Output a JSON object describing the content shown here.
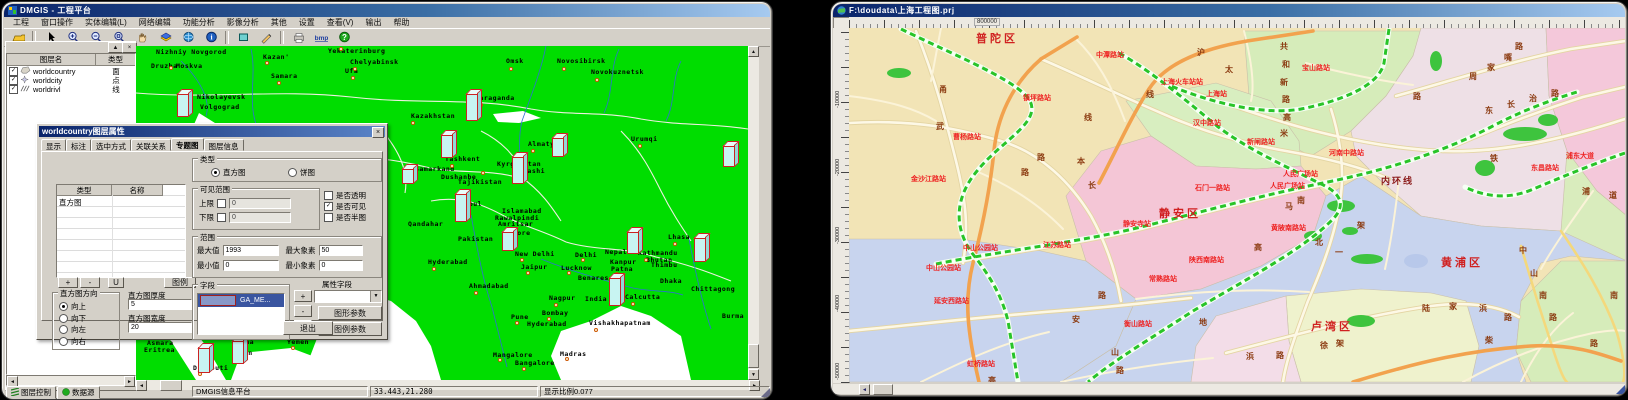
{
  "left_window": {
    "title": "DMGIS - 工程平台",
    "menus": [
      "工程",
      "窗口操作",
      "实体编辑(L)",
      "网络编辑",
      "功能分析",
      "影像分析",
      "其他",
      "设置",
      "查看(V)",
      "输出",
      "帮助"
    ],
    "toolbar_icons": [
      "open-folder",
      "select-arrow",
      "zoom-in",
      "zoom-out",
      "zoom-window",
      "pan-hand",
      "layers-flag",
      "refresh-globe",
      "info",
      "select-rect",
      "measure-pencil",
      "print",
      "export-bmp",
      "help"
    ],
    "layer_panel": {
      "headers": [
        "图层名",
        "类型"
      ],
      "min_button": "▲",
      "close_button": "×",
      "layers": [
        {
          "name": "worldcountry",
          "type": "面",
          "checked": true,
          "icon": "polygon-layer-icon"
        },
        {
          "name": "worldcity",
          "type": "点",
          "checked": true,
          "icon": "point-layer-icon"
        },
        {
          "name": "worldrivl",
          "type": "线",
          "checked": true,
          "icon": "line-layer-icon"
        }
      ],
      "tabs": [
        "图层控制",
        "数据源"
      ]
    },
    "status_bar": [
      "DMGIS信息平台",
      "33.443,21.280",
      "显示比例0.077"
    ],
    "map": {
      "cities": [
        [
          "Nizhniy Novgorod",
          155,
          50
        ],
        [
          "Druzba",
          150,
          64
        ],
        [
          "Moskva",
          175,
          64
        ],
        [
          "Kazan'",
          262,
          55
        ],
        [
          "Perm'",
          333,
          40
        ],
        [
          "Yekaterinburg",
          327,
          49
        ],
        [
          "Chelyabinsk",
          349,
          60
        ],
        [
          "Samara",
          270,
          74
        ],
        [
          "Ufa",
          344,
          69
        ],
        [
          "Nikolayevsk",
          196,
          95
        ],
        [
          "Volgograd",
          199,
          105
        ],
        [
          "Russia",
          619,
          33
        ],
        [
          "Omsk",
          505,
          59
        ],
        [
          "Novosibirsk",
          556,
          59
        ],
        [
          "Novokuznetsk",
          590,
          70
        ],
        [
          "Karaganda",
          474,
          96
        ],
        [
          "Kazakhstan",
          410,
          114
        ],
        [
          "Almaty",
          527,
          142
        ],
        [
          "Urumqi",
          630,
          137
        ],
        [
          "Tashkent",
          444,
          157
        ],
        [
          "Samarkand",
          414,
          167
        ],
        [
          "Kyrgyzstan",
          496,
          162
        ],
        [
          "Kashi",
          522,
          169
        ],
        [
          "Dushanbe",
          440,
          175
        ],
        [
          "Tajikistan",
          457,
          180
        ],
        [
          "Kabul",
          459,
          202
        ],
        [
          "Islamabad",
          501,
          209
        ],
        [
          "Rawalpindi",
          494,
          216
        ],
        [
          "Amritsar",
          497,
          222
        ],
        [
          "Lahore",
          503,
          231
        ],
        [
          "Qandahar",
          407,
          222
        ],
        [
          "Pakistan",
          457,
          237
        ],
        [
          "New Delhi",
          514,
          252
        ],
        [
          "Delhi",
          574,
          253
        ],
        [
          "Jaipur",
          520,
          265
        ],
        [
          "Lucknow",
          560,
          266
        ],
        [
          "Kanpur",
          609,
          260
        ],
        [
          "Patna",
          610,
          267
        ],
        [
          "Nepal",
          604,
          250
        ],
        [
          "Kathmandu",
          637,
          251
        ],
        [
          "Bhutan",
          645,
          258
        ],
        [
          "Thimbu",
          650,
          263
        ],
        [
          "Lhasa",
          667,
          235
        ],
        [
          "Hyderabad",
          427,
          260
        ],
        [
          "Ahmadabad",
          468,
          284
        ],
        [
          "Nagpur",
          548,
          296
        ],
        [
          "India",
          584,
          297
        ],
        [
          "Calcutta",
          624,
          295
        ],
        [
          "Benares",
          577,
          276
        ],
        [
          "Dhaka",
          659,
          279
        ],
        [
          "Chittagong",
          690,
          287
        ],
        [
          "Bombay",
          541,
          311
        ],
        [
          "Pune",
          510,
          315
        ],
        [
          "Hyderabad",
          526,
          322
        ],
        [
          "Vishakhapatnam",
          588,
          321
        ],
        [
          "Burma",
          721,
          314
        ],
        [
          "Mangalore",
          492,
          353
        ],
        [
          "Madras",
          559,
          352
        ],
        [
          "Bangalore",
          514,
          361
        ],
        [
          "Asmara",
          146,
          341
        ],
        [
          "Eritrea",
          143,
          348
        ],
        [
          "Sanaa",
          231,
          340
        ],
        [
          "Aden",
          234,
          351
        ],
        [
          "Yemen",
          286,
          340
        ],
        [
          "Djibouti",
          192,
          366
        ]
      ],
      "dots": [
        [
          168,
          65
        ],
        [
          264,
          60
        ],
        [
          338,
          46
        ],
        [
          352,
          66
        ],
        [
          276,
          80
        ],
        [
          350,
          75
        ],
        [
          508,
          66
        ],
        [
          561,
          66
        ],
        [
          594,
          77
        ],
        [
          478,
          102
        ],
        [
          530,
          148
        ],
        [
          637,
          143
        ],
        [
          449,
          163
        ],
        [
          463,
          209
        ],
        [
          504,
          237
        ],
        [
          519,
          257
        ],
        [
          580,
          257
        ],
        [
          525,
          270
        ],
        [
          566,
          270
        ],
        [
          614,
          271
        ],
        [
          643,
          257
        ],
        [
          672,
          241
        ],
        [
          431,
          266
        ],
        [
          473,
          290
        ],
        [
          553,
          302
        ],
        [
          630,
          301
        ],
        [
          546,
          316
        ],
        [
          514,
          320
        ],
        [
          593,
          327
        ],
        [
          497,
          357
        ],
        [
          564,
          356
        ],
        [
          521,
          366
        ],
        [
          237,
          355
        ],
        [
          290,
          345
        ],
        [
          197,
          371
        ],
        [
          410,
          120
        ],
        [
          480,
          170
        ]
      ],
      "bars": [
        [
          176,
          92,
          24
        ],
        [
          197,
          346,
          26
        ],
        [
          231,
          339,
          24
        ],
        [
          465,
          92,
          28
        ],
        [
          440,
          133,
          24
        ],
        [
          551,
          136,
          20
        ],
        [
          646,
          31,
          13
        ],
        [
          401,
          167,
          16
        ],
        [
          511,
          155,
          28
        ],
        [
          454,
          192,
          29
        ],
        [
          501,
          230,
          20
        ],
        [
          626,
          230,
          23
        ],
        [
          693,
          236,
          25
        ],
        [
          608,
          276,
          29
        ],
        [
          722,
          144,
          22
        ]
      ]
    }
  },
  "dialog": {
    "title": "worldcountry图层属性",
    "close_glyph": "×",
    "tabs": [
      "显示",
      "标注",
      "选中方式",
      "关联关系",
      "专题图",
      "图层信息"
    ],
    "active_tab_index": 4,
    "table": {
      "headers": [
        "类型",
        "名称"
      ],
      "rows": [
        [
          "直方图",
          ""
        ]
      ]
    },
    "list_buttons": [
      "+",
      "-",
      "U"
    ],
    "legend_button": "图例",
    "type_group": {
      "label": "类型",
      "option1": "直方图",
      "option2": "饼图",
      "selected": "直方图"
    },
    "visible_range": {
      "label": "可见范围",
      "upper_label": "上限",
      "upper_value": "0",
      "lower_label": "下限",
      "lower_value": "0"
    },
    "checks": [
      {
        "label": "是否透明",
        "checked": false
      },
      {
        "label": "是否可见",
        "checked": true
      },
      {
        "label": "是否半图",
        "checked": false
      }
    ],
    "range_group": {
      "label": "范围",
      "max_label": "最大值",
      "max_value": "1993",
      "maxpx_label": "最大象素",
      "maxpx_value": "50",
      "min_label": "最小值",
      "min_value": "0",
      "minpx_label": "最小象素",
      "minpx_value": "0"
    },
    "direction_group": {
      "label": "直方图方向",
      "options": [
        "向上",
        "向下",
        "向左",
        "向右"
      ],
      "selected_index": 0
    },
    "thickness_label": "直方图厚度",
    "thickness_value": "5",
    "width_label": "直方图宽度",
    "width_value": "20",
    "field_group": {
      "label": "字段",
      "selected_item": "GA_ME..."
    },
    "field_buttons": [
      "+",
      "-",
      "U"
    ],
    "attr_field_label": "属性字段",
    "graphic_param_button": "图形参数",
    "legend_param_button": "图例参数",
    "exit_button": "退出"
  },
  "right_window": {
    "title": "F:\\doudata\\上海工程图.prj",
    "ruler": {
      "top_label": "800000",
      "left_labels": [
        [
          "-10000",
          60
        ],
        [
          "-20000",
          128
        ],
        [
          "-30000",
          196
        ],
        [
          "-40000",
          264
        ],
        [
          "-50000",
          332
        ]
      ]
    },
    "map": {
      "districts": [
        [
          "普陀区",
          975,
          29
        ],
        [
          "静安区",
          1158,
          204
        ],
        [
          "黄浦区",
          1440,
          253
        ],
        [
          "卢湾区",
          1310,
          317
        ]
      ],
      "ring_road_label": [
        "内环线",
        1380,
        173
      ],
      "stations": [
        [
          "中潭路站",
          1095,
          49
        ],
        [
          "上海火车站站",
          1160,
          76
        ],
        [
          "上海站",
          1205,
          88
        ],
        [
          "镇坪路站",
          1022,
          92
        ],
        [
          "曹杨路站",
          952,
          131
        ],
        [
          "金沙江路站",
          910,
          173
        ],
        [
          "汉中路站",
          1192,
          117
        ],
        [
          "新闸路站",
          1246,
          136
        ],
        [
          "石门一路站",
          1194,
          182
        ],
        [
          "静安寺站",
          1122,
          218
        ],
        [
          "中山公园站",
          962,
          242
        ],
        [
          "中山公园站",
          925,
          262
        ],
        [
          "江苏路站",
          1042,
          239
        ],
        [
          "陕西南路站",
          1188,
          254
        ],
        [
          "人民广场站",
          1282,
          168
        ],
        [
          "人民广场站",
          1269,
          180
        ],
        [
          "河南中路站",
          1328,
          147
        ],
        [
          "黄陂南路站",
          1270,
          222
        ],
        [
          "宝山路站",
          1301,
          62
        ],
        [
          "东昌路站",
          1530,
          162
        ],
        [
          "常熟路站",
          1148,
          273
        ],
        [
          "衡山路站",
          1123,
          318
        ],
        [
          "延安西路站",
          933,
          295
        ],
        [
          "虹桥路站",
          966,
          358
        ],
        [
          "浦东大道",
          1565,
          150
        ]
      ],
      "road_chars": [
        [
          "沪",
          1196,
          46
        ],
        [
          "太",
          1224,
          63
        ],
        [
          "甬",
          938,
          83
        ],
        [
          "武",
          935,
          120
        ],
        [
          "共",
          1279,
          40
        ],
        [
          "和",
          1281,
          58
        ],
        [
          "新",
          1279,
          76
        ],
        [
          "路",
          1281,
          93
        ],
        [
          "高",
          1282,
          111
        ],
        [
          "米",
          1279,
          127
        ],
        [
          "周",
          1468,
          70
        ],
        [
          "家",
          1486,
          61
        ],
        [
          "嘴",
          1503,
          51
        ],
        [
          "路",
          1514,
          40
        ],
        [
          "路",
          1412,
          90
        ],
        [
          "东",
          1484,
          104
        ],
        [
          "长",
          1506,
          98
        ],
        [
          "治",
          1528,
          92
        ],
        [
          "路",
          1550,
          87
        ],
        [
          "路",
          1036,
          151
        ],
        [
          "路",
          1020,
          166
        ],
        [
          "本",
          1076,
          155
        ],
        [
          "长",
          1087,
          179
        ],
        [
          "线",
          1083,
          111
        ],
        [
          "线",
          1145,
          88
        ],
        [
          "安",
          1071,
          313
        ],
        [
          "路",
          1097,
          289
        ],
        [
          "山",
          1110,
          346
        ],
        [
          "路",
          1115,
          364
        ],
        [
          "高",
          987,
          374
        ],
        [
          "地",
          1198,
          316
        ],
        [
          "徐",
          1319,
          339
        ],
        [
          "架",
          1335,
          337
        ],
        [
          "浜",
          1245,
          350
        ],
        [
          "路",
          1275,
          349
        ],
        [
          "陆",
          1421,
          302
        ],
        [
          "家",
          1448,
          300
        ],
        [
          "浜",
          1478,
          302
        ],
        [
          "路",
          1503,
          311
        ],
        [
          "柴",
          1484,
          334
        ],
        [
          "南",
          1538,
          289
        ],
        [
          "南",
          1609,
          289
        ],
        [
          "路",
          1589,
          337
        ],
        [
          "中",
          1518,
          244
        ],
        [
          "山",
          1529,
          267
        ],
        [
          "路",
          1548,
          311
        ],
        [
          "铁",
          1489,
          152
        ],
        [
          "浦",
          1581,
          185
        ],
        [
          "道",
          1608,
          189
        ],
        [
          "马",
          1284,
          200
        ],
        [
          "南",
          1296,
          194
        ],
        [
          "架",
          1356,
          219
        ],
        [
          "北",
          1314,
          236
        ],
        [
          "一",
          1334,
          246
        ],
        [
          "高",
          1253,
          241
        ]
      ]
    }
  }
}
